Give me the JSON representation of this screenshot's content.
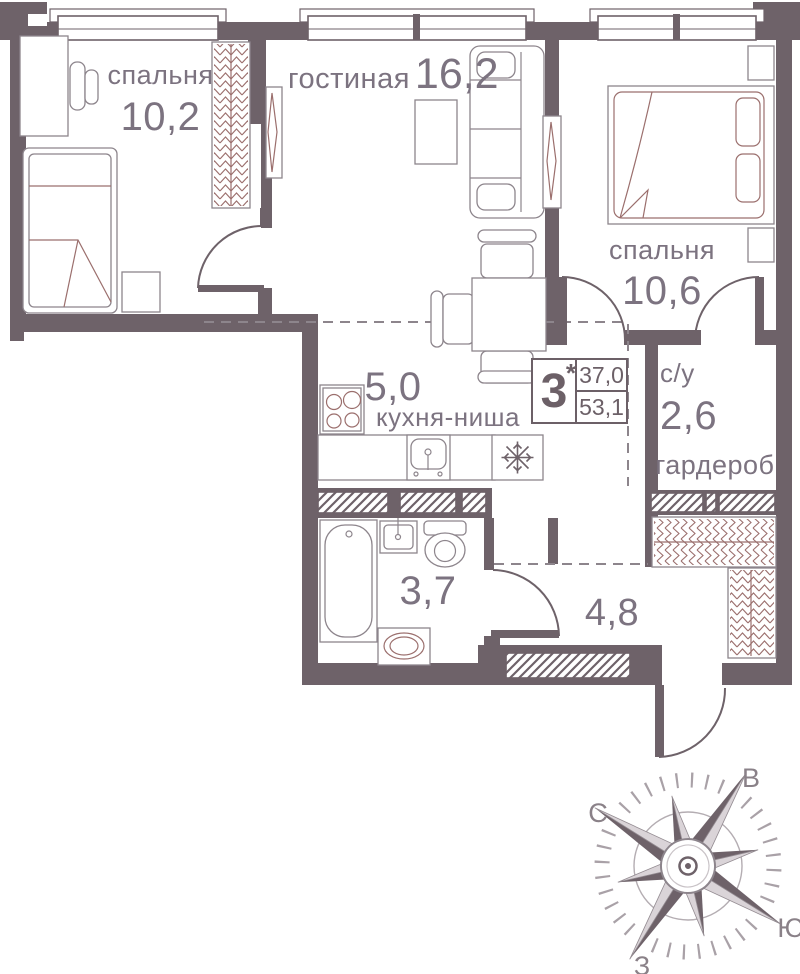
{
  "plan": {
    "title": "apartment floor plan",
    "rooms": {
      "bedroom1": {
        "label": "спальня",
        "area": "10,2"
      },
      "living": {
        "label": "гостиная",
        "area": "16,2"
      },
      "bedroom2": {
        "label": "спальня",
        "area": "10,6"
      },
      "kitchen": {
        "label": "кухня-ниша",
        "area": "5,0"
      },
      "bathroom2": {
        "label": "с/у",
        "area": "2,6"
      },
      "wardrobe": {
        "label": "гардероб"
      },
      "bathroom1": {
        "area": "3,7"
      },
      "hallway": {
        "area": "4,8"
      }
    },
    "info_badge": {
      "rooms_count": "3",
      "star": "*",
      "living_area": "37,0",
      "total_area": "53,1"
    },
    "compass": {
      "north": "С",
      "east": "В",
      "south": "Ю",
      "west": "З"
    },
    "colors": {
      "wall": "#6e6269",
      "furniture_line": "#9b6f6d",
      "fixture_line": "#8d858c",
      "text": "#7c7380"
    }
  }
}
